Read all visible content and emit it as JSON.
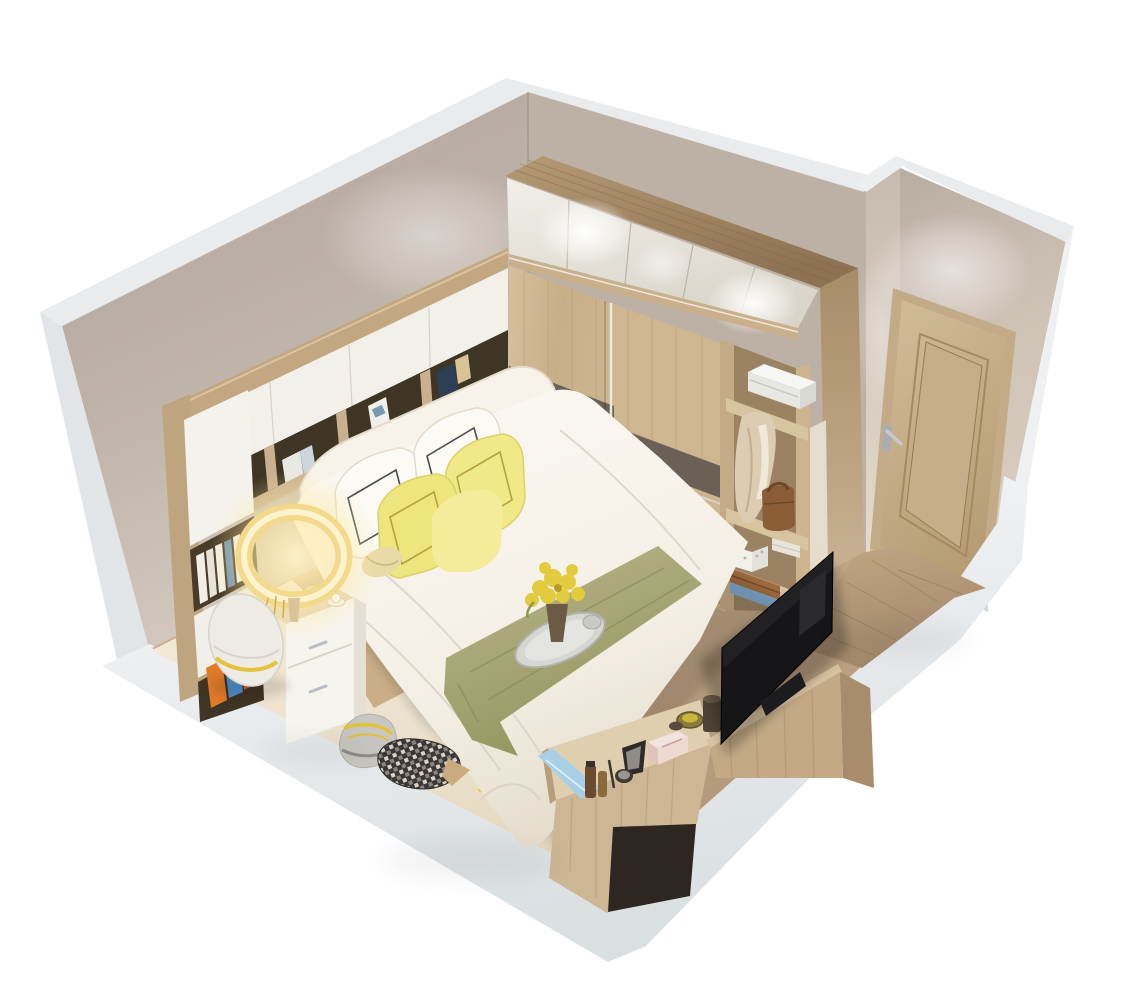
{
  "meta": {
    "description": "Isometric cutaway 3D rendering of a small modern bedroom (dollhouse view) on a white background",
    "view": "axonometric cutaway from above-left"
  },
  "palette": {
    "wall_beige": "#b4a89e",
    "wall_beige_light": "#cfc5ba",
    "wall_cut_white": "#e9ebed",
    "wall_cut_shade": "#dde1e4",
    "plinth_white": "#f2f4f5",
    "floor_wood": "#c4a987",
    "floor_entry_wood": "#b3987a",
    "floor_cream": "#efe5d1",
    "wardrobe_top_wood": "#a98e6a",
    "wardrobe_door_white": "#efede6",
    "wardrobe_slide_wood": "#d0ba96",
    "wardrobe_stripe": "#6a6156",
    "shelf_interior": "#3f3525",
    "unit_wood": "#c2a781",
    "door_wood": "#c9b38e",
    "door_frame": "#c3ab87",
    "handle_silver": "#b9bcc0",
    "bed_white": "#faf8f2",
    "runner_olive": "#aeac7e",
    "pillow_yellow": "#f1e887",
    "pillow_white": "#fbfaf5",
    "lamp_glow": "#f7e49b",
    "nightstand_white": "#f6f4ef",
    "tv_black": "#161618",
    "tv_cabinet_wood": "#c3aa85",
    "desk_wood": "#cdb693",
    "coat_beige": "#dcccb2",
    "bag_brown": "#8a5d37",
    "box_blue": "#7fa9cc",
    "box_brown": "#a06b3f",
    "book_orange": "#e07b28",
    "book_blue": "#4f8fc9",
    "flower_yellow": "#e3cb3f",
    "checker_dark": "#3b3734",
    "petal_yellow": "#ecc93f",
    "cloth_blue": "#a9cfe7"
  },
  "objects": {
    "room": "bedroom",
    "walls": [
      "left wall",
      "wardrobe wall",
      "door alcove wall"
    ],
    "furniture": [
      "double bed with white duvet and olive runner",
      "headboard storage wall unit with books",
      "white nightstand with teapot and cup",
      "glowing ring table lamp",
      "sliding-door wardrobe with lit top cabinets",
      "open shelf column with storage box, coat and handbag",
      "TV on low wood cabinet",
      "vanity desk with cosmetics",
      "interior panel door",
      "floor cushions and checkered pillow",
      "tray with yellow flowers on bed"
    ]
  }
}
